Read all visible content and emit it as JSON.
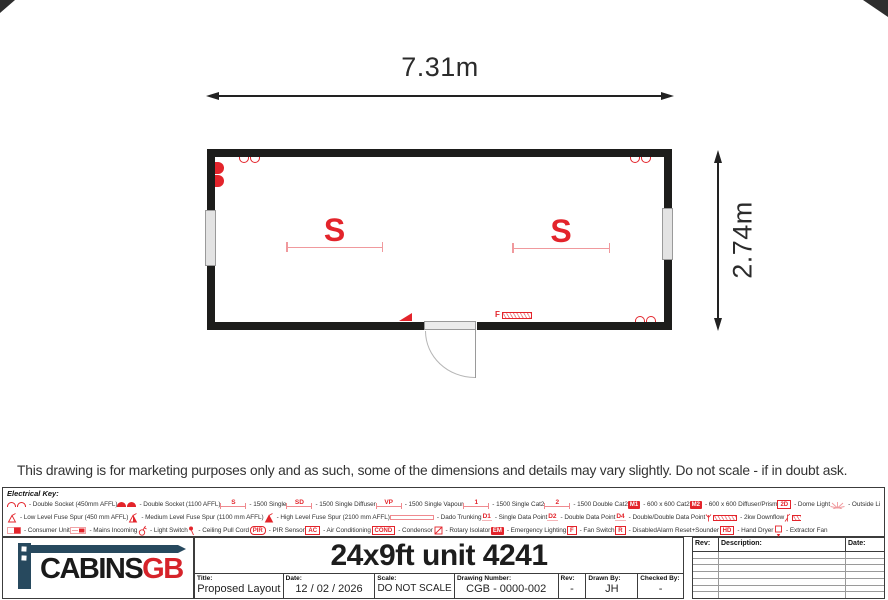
{
  "colors": {
    "accent_red": "#e3242b",
    "light_red": "#f0999d",
    "wall_black": "#1d1d1b",
    "logo_blue": "#27495e",
    "logo_red": "#d6232a"
  },
  "plan": {
    "width_dim": "7.31m",
    "height_dim": "2.74m",
    "lights": [
      "S",
      "S"
    ],
    "symbols": [
      "double-socket-icon",
      "double-socket-icon",
      "double-socket-icon",
      "mains-incoming-icon",
      "light-switch-icon",
      "fan-switch-icon",
      "convector-heater-icon",
      "door",
      "window",
      "window"
    ]
  },
  "disclaimer": "This drawing is for marketing purposes only and as such, some of the dimensions and details may vary slightly. Do not scale - if in doubt ask.",
  "key": {
    "title": "Electrical Key:",
    "rows": [
      [
        {
          "icon": "socket-outline",
          "label": "- Double Socket (450mm AFFL)"
        },
        {
          "icon": "socket-filled",
          "label": "- Double Socket (1100 AFFL)"
        },
        {
          "icon": "strip",
          "sym": "S",
          "label": "- 1500 Single"
        },
        {
          "icon": "strip",
          "sym": "SD",
          "label": "- 1500 Single Diffuser"
        },
        {
          "icon": "strip",
          "sym": "VP",
          "label": "- 1500 Single Vapour"
        },
        {
          "icon": "strip",
          "sym": "1",
          "label": "- 1500 Single Cat2"
        },
        {
          "icon": "strip",
          "sym": "2",
          "label": "- 1500 Double Cat2"
        },
        {
          "icon": "box-filled",
          "sym": "M1",
          "label": "- 600 x 600 Cat2"
        },
        {
          "icon": "box-filled",
          "sym": "M2",
          "label": "- 600 x 600 Diffuser/Prism"
        },
        {
          "icon": "box-outline",
          "sym": "2D",
          "label": "- Dome Light"
        },
        {
          "icon": "sun",
          "label": "- Outside Light"
        }
      ],
      [
        {
          "icon": "spur-low",
          "label": "- Low Level Fuse Spur (450 mm AFFL)"
        },
        {
          "icon": "spur-med",
          "label": "- Medium Level Fuse Spur (1100 mm AFFL)"
        },
        {
          "icon": "spur-high",
          "label": "- High Level Fuse Spur (2100 mm AFFL)"
        },
        {
          "icon": "trunking",
          "label": "- Dado Trunking"
        },
        {
          "icon": "text-red",
          "sym": "D1",
          "label": "- Single Data Point"
        },
        {
          "icon": "text-red",
          "sym": "D2",
          "label": "- Double Data Point"
        },
        {
          "icon": "text-red",
          "sym": "D4",
          "label": "- Double/Double Data Point"
        },
        {
          "icon": "downflow",
          "label": "- 2kw Downflow"
        },
        {
          "icon": "convector",
          "label": "- 2kw Convector"
        }
      ],
      [
        {
          "icon": "consumer-unit",
          "label": "- Consumer Unit"
        },
        {
          "icon": "mains",
          "label": "- Mains Incoming"
        },
        {
          "icon": "switch",
          "label": "- Light Switch"
        },
        {
          "icon": "pullcord",
          "label": "- Ceiling Pull Cord"
        },
        {
          "icon": "box-round",
          "sym": "PIR",
          "label": "- PIR Sensor"
        },
        {
          "icon": "box-outline",
          "sym": "AC",
          "label": "- Air Conditioning"
        },
        {
          "icon": "box-outline",
          "sym": "COND",
          "label": "- Condensor"
        },
        {
          "icon": "rotary",
          "label": "- Rotary Isolator"
        },
        {
          "icon": "box-filled",
          "sym": "EM",
          "label": "- Emergency Lighting"
        },
        {
          "icon": "box-outline",
          "sym": "F",
          "label": "- Fan Switch"
        },
        {
          "icon": "box-outline",
          "sym": "R",
          "label": "- DisabledAlarm Reset+Sounder"
        },
        {
          "icon": "box-outline",
          "sym": "HD",
          "label": "- Hand Dryer"
        },
        {
          "icon": "fan",
          "label": "- Extractor Fan"
        }
      ]
    ]
  },
  "title_block": {
    "logo": {
      "black": "CABINS",
      "red": "GB"
    },
    "title": "24x9ft unit 4241",
    "fields": [
      {
        "label": "Title:",
        "value": "Proposed Layout"
      },
      {
        "label": "Date:",
        "value": "12 / 02 / 2026"
      },
      {
        "label": "Scale:",
        "value": "DO NOT SCALE"
      },
      {
        "label": "Drawing Number:",
        "value": "CGB - 0000-002"
      },
      {
        "label": "Rev:",
        "value": "-"
      },
      {
        "label": "Drawn By:",
        "value": "JH"
      },
      {
        "label": "Checked By:",
        "value": "-"
      }
    ],
    "revision_table": {
      "headers": [
        "Rev:",
        "Description:",
        "Date:"
      ],
      "empty_rows": 7
    }
  }
}
